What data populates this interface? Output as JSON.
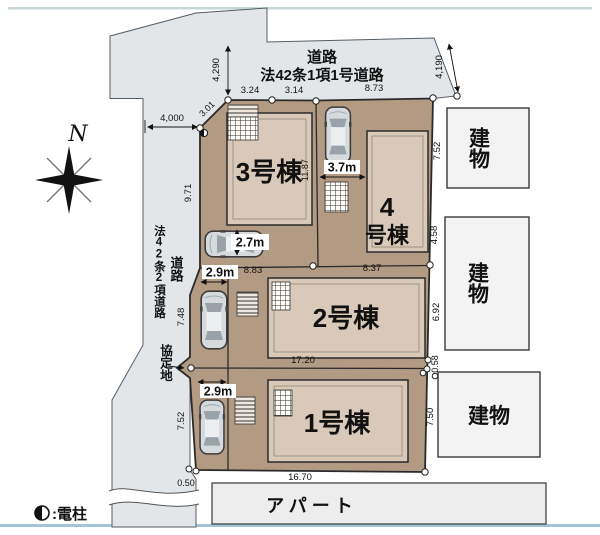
{
  "compass": {
    "north": "N"
  },
  "legend": {
    "pole_symbol": "◐",
    "pole_label": ":電柱"
  },
  "roads": {
    "top_name": "道路",
    "top_law": "法42条1項1号道路",
    "west_name": "道路",
    "west_law": "法42条2項道路",
    "agreement": "協定地"
  },
  "units": {
    "unit1": "1号棟",
    "unit2": "2号棟",
    "unit3": "3号棟",
    "unit4_line1": "4",
    "unit4_line2": "号棟"
  },
  "neighbors": {
    "n1": "建物",
    "n2": "建物",
    "n3": "建物",
    "apartment": "アパート"
  },
  "parking": {
    "unit1": "2.9m",
    "unit2": "2.9m",
    "unit3": "2.7m",
    "unit4": "3.7m"
  },
  "dims": {
    "road_west_width": "4,000",
    "road_top_left": "4,290",
    "road_top_right": "4,190",
    "corner_cut": "3.01",
    "front_1": "3.24",
    "front_2": "3.14",
    "front_3": "8.73",
    "west_upper": "9.71",
    "center_vertical": "11.87",
    "west_mid": "7.48",
    "west_lower": "7.52",
    "west_step": "0.50",
    "mid_left": "8.83",
    "mid_right": "8.37",
    "mid_width": "17.20",
    "south_width": "16.70",
    "east_1": "7.52",
    "east_2": "4.58",
    "east_3": "6.92",
    "east_4": "0.58",
    "east_5": "7.50"
  },
  "colors": {
    "road": "#e3e6e9",
    "lot": "#b39a82",
    "building_fill": "#d8c9b8",
    "neighbor": "#f3f3f3",
    "apartment": "#ededed",
    "accent_top": "#c6d8d8",
    "accent_bottom": "#a2c4d6"
  }
}
